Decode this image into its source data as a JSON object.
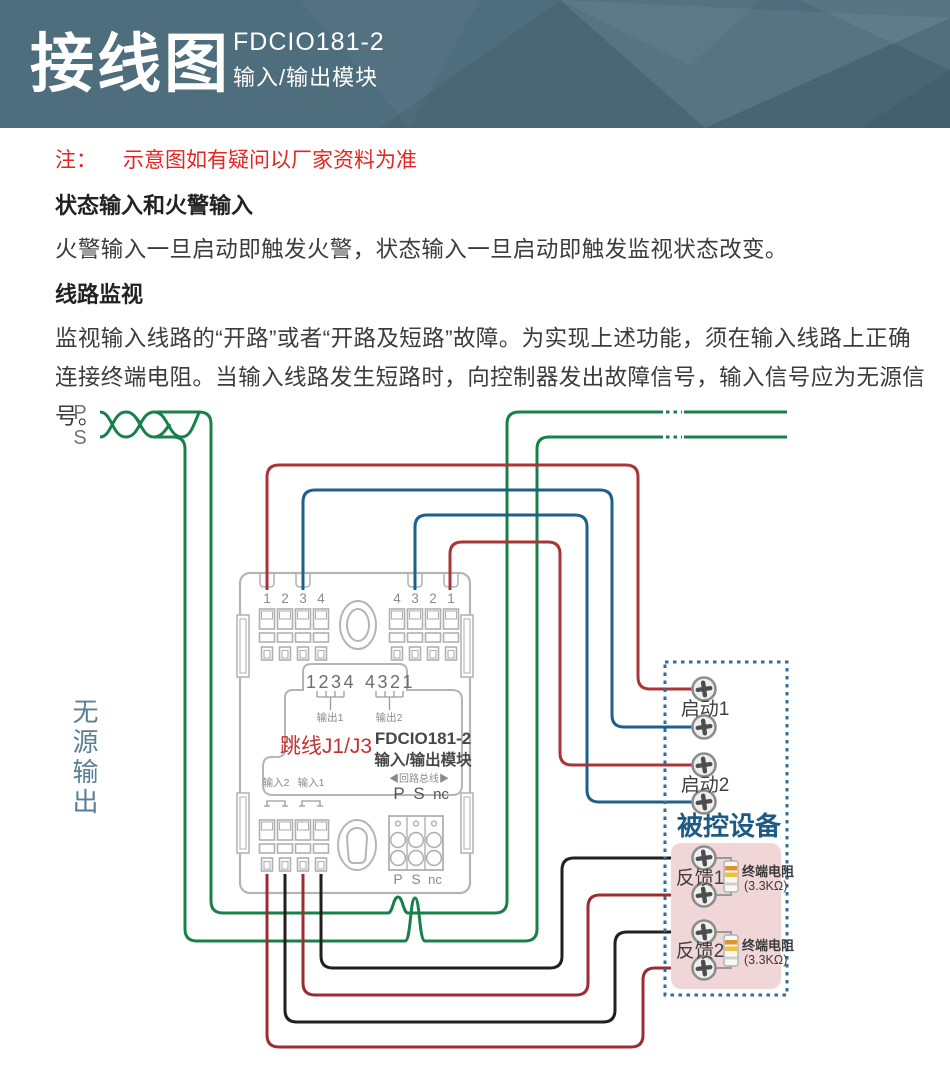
{
  "header": {
    "title": "接线图",
    "model": "FDCIO181-2",
    "subtitle": "输入/输出模块"
  },
  "notes": {
    "prefix": "注：",
    "text": "示意图如有疑问以厂家资料为准",
    "section1": {
      "heading": "状态输入和火警输入",
      "body": "火警输入一旦启动即触发火警，状态输入一旦启动即触发监视状态改变。"
    },
    "section2": {
      "heading": "线路监视",
      "body": "监视输入线路的“开路”或者“开路及短路”故障。为实现上述功能，须在输入线路上正确连接终端电阻。当输入线路发生短路时，向控制器发出故障信号，输入信号应为无源信号。"
    }
  },
  "diagram": {
    "bus": {
      "p": "P",
      "s": "S"
    },
    "passive_output_label": "无源输出",
    "module": {
      "top_left_terminals": [
        "1",
        "2",
        "3",
        "4"
      ],
      "top_right_terminals": [
        "4",
        "3",
        "2",
        "1"
      ],
      "pins_left": "1234",
      "pins_right": "4321",
      "output1_label": "输出1",
      "output2_label": "输出2",
      "jumper_label": "跳线J1/J3",
      "model": "FDCIO181-2",
      "model_subtitle": "输入/输出模块",
      "input2_label": "输入2",
      "input1_label": "输入1",
      "loop_bus_label": "◀回路总线▶",
      "pins": {
        "p": "P",
        "s": "S",
        "nc": "nc"
      }
    },
    "device_box": {
      "title": "被控设备",
      "start1": "启动1",
      "start2": "启动2",
      "feedback1": "反馈1",
      "feedback2": "反馈2",
      "resistor_label": "终端电阻",
      "resistor_value": "(3.3KΩ)"
    },
    "colors": {
      "loop_green": "#17804b",
      "output_red": "#a93538",
      "output_blue": "#1f5f8b",
      "feedback_black": "#231f1c",
      "feedback_red": "#9d2c30",
      "device_blue": "#1d5a85",
      "module_gray": "#b5b5b5"
    }
  }
}
